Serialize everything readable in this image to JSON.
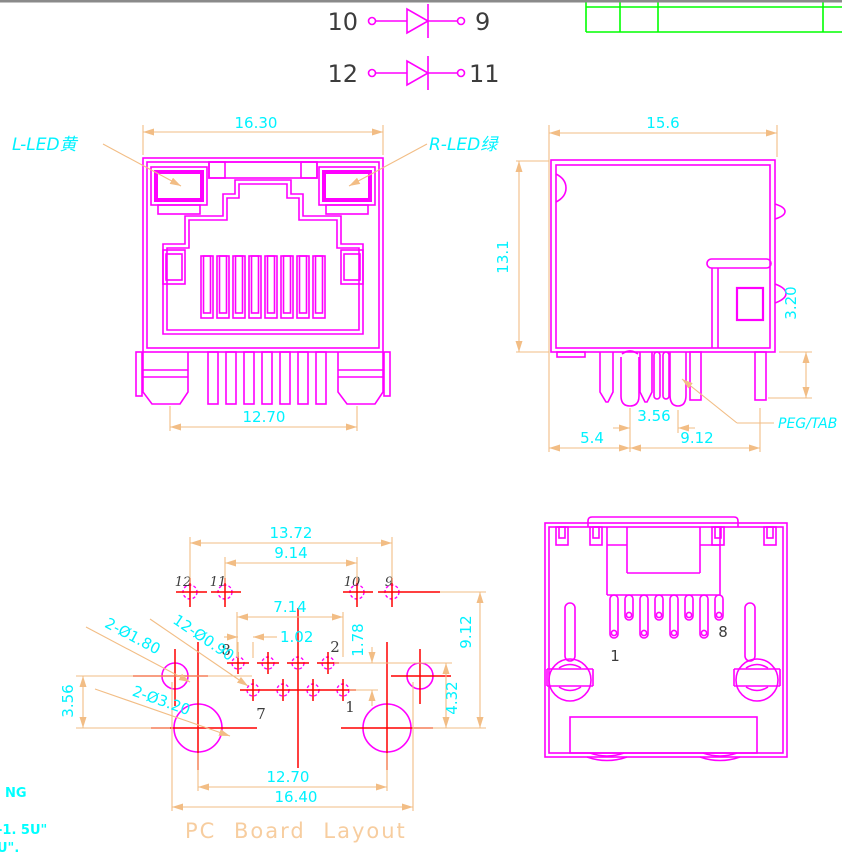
{
  "colors": {
    "part_outline": "#FF00FF",
    "dimension_lines": "#F2BD85",
    "dimension_text": "#00F2FF",
    "centerlines": "#FF0000",
    "title_block": "#00FF00",
    "drawing_title": "#F7CD9F",
    "numbers": "#3C3C3C"
  },
  "schematic": {
    "diodes": [
      {
        "left_pin": "10",
        "right_pin": "9"
      },
      {
        "left_pin": "12",
        "right_pin": "11"
      }
    ]
  },
  "front_view": {
    "led_left_label": "L-LED黄",
    "led_right_label": "R-LED绿",
    "dim_width": "16.30",
    "dim_feet": "12.70"
  },
  "side_view": {
    "dim_width": "15.6",
    "dim_height": "13.1",
    "dim_standoff": "3.20",
    "dim_peg_pitch": "3.56",
    "dim_edge": "5.4",
    "dim_span": "9.12",
    "peg_label": "PEG/TAB"
  },
  "pcb": {
    "title": "PC Board Layout",
    "dims": {
      "d1372": "13.72",
      "d914": "9.14",
      "d714": "7.14",
      "d102": "1.02",
      "d178": "1.78",
      "d432": "4.32",
      "d912": "9.12",
      "d356": "3.56",
      "d1270": "12.70",
      "d1640": "16.40"
    },
    "callouts": {
      "pegs": "2-Ø1.80",
      "pins": "12-Ø0.90",
      "shield": "2-Ø3.20"
    },
    "top_labels": [
      "12",
      "11",
      "10",
      "9"
    ],
    "pin_labels": {
      "p8": "8",
      "p2": "2",
      "p7": "7",
      "p1": "1"
    }
  },
  "bottom_view": {
    "pin_first": "1",
    "pin_last": "8"
  },
  "notes": {
    "line1": "NG",
    "line2": "-1. 5U\"",
    "line3": "U\"."
  }
}
